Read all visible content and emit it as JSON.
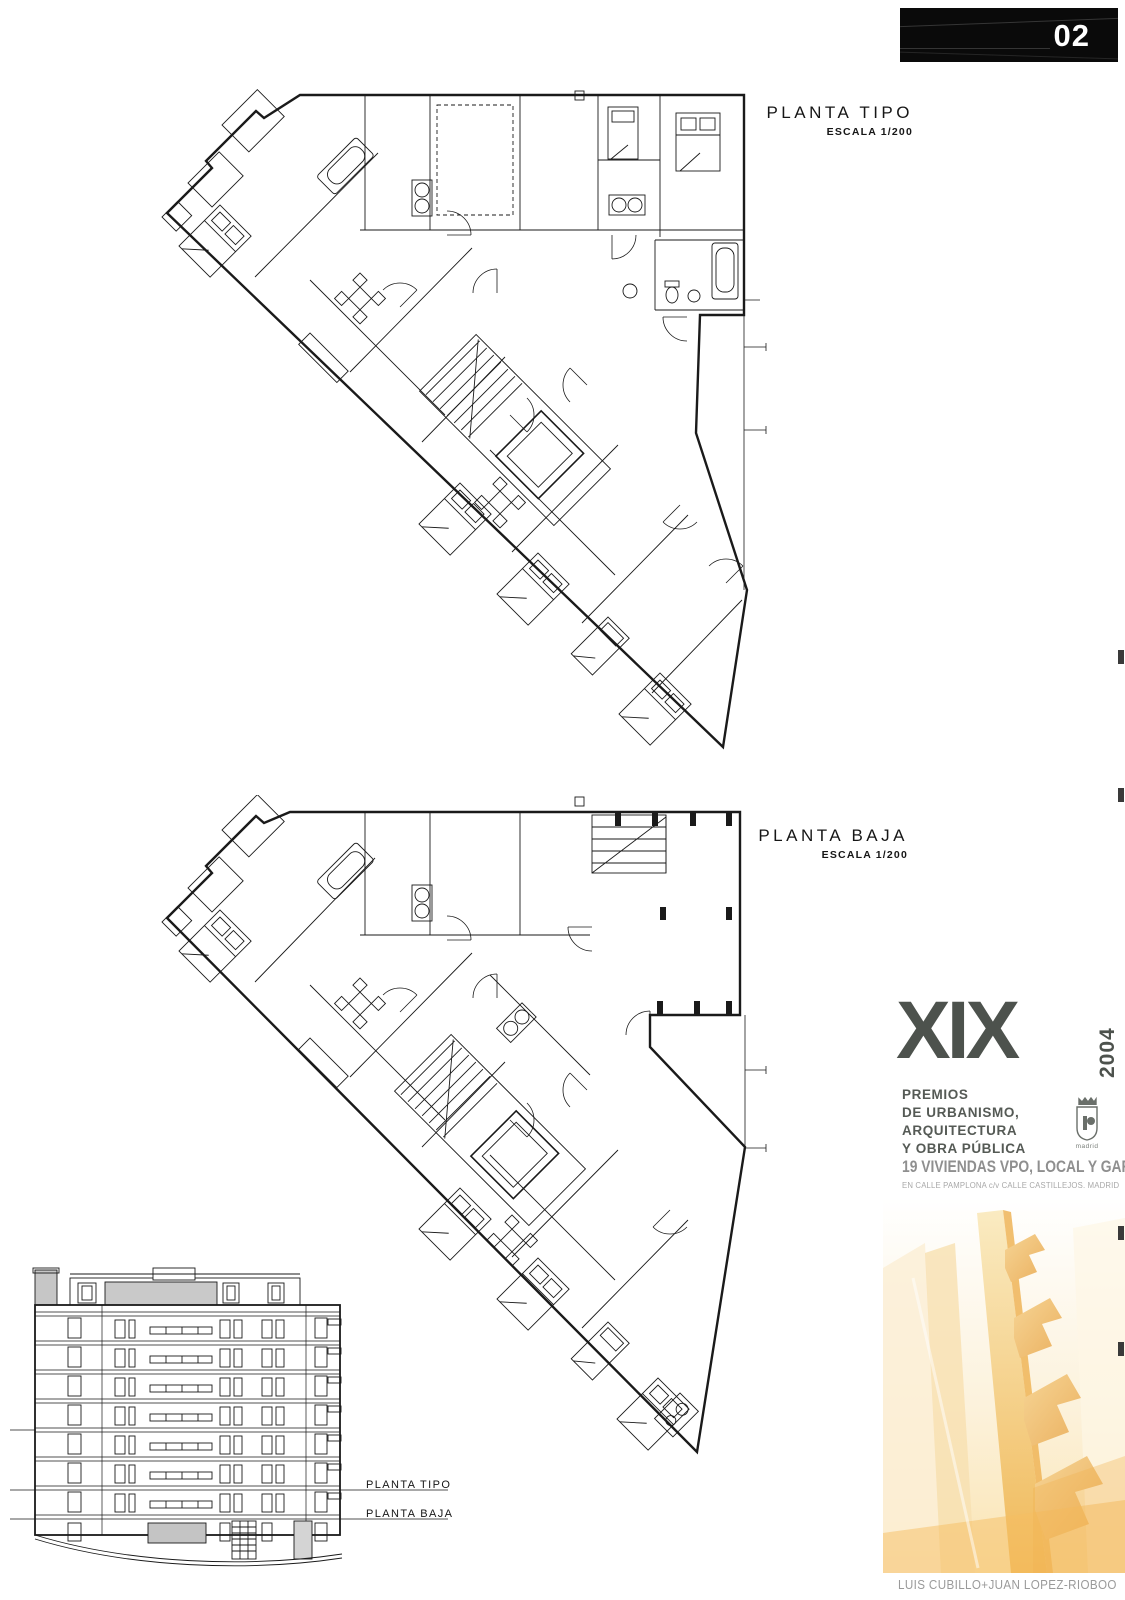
{
  "banner": {
    "number": "02",
    "bg": "#0a0a0a",
    "text_color": "#ffffff"
  },
  "plans": [
    {
      "id": "planta-tipo",
      "title": "PLANTA TIPO",
      "scale": "ESCALA 1/200"
    },
    {
      "id": "planta-baja",
      "title": "PLANTA BAJA",
      "scale": "ESCALA 1/200"
    }
  ],
  "elevation": {
    "labels": [
      {
        "text": "PLANTA TIPO"
      },
      {
        "text": "PLANTA BAJA"
      }
    ]
  },
  "award": {
    "roman": "XIX",
    "year": "2004",
    "lines": [
      "PREMIOS",
      "DE URBANISMO,",
      "ARQUITECTURA",
      "Y OBRA PÚBLICA"
    ],
    "emblem_caption": "madrid",
    "accent": "#4d524d"
  },
  "project": {
    "title": "19 VIVIENDAS VPO, LOCAL Y GARAJE",
    "location": "EN CALLE PAMPLONA c/v CALLE CASTILLEJOS. MADRID",
    "architects": "LUIS CUBILLO+JUAN LOPEZ-RIOBOO"
  },
  "artwork": {
    "colors": {
      "mast": "#F6E0A6",
      "chevron": "#EDC07A",
      "wash": "#F3C97E",
      "bg_top": "#FFFFFF",
      "bg_bottom": "#FAE4B2"
    }
  }
}
